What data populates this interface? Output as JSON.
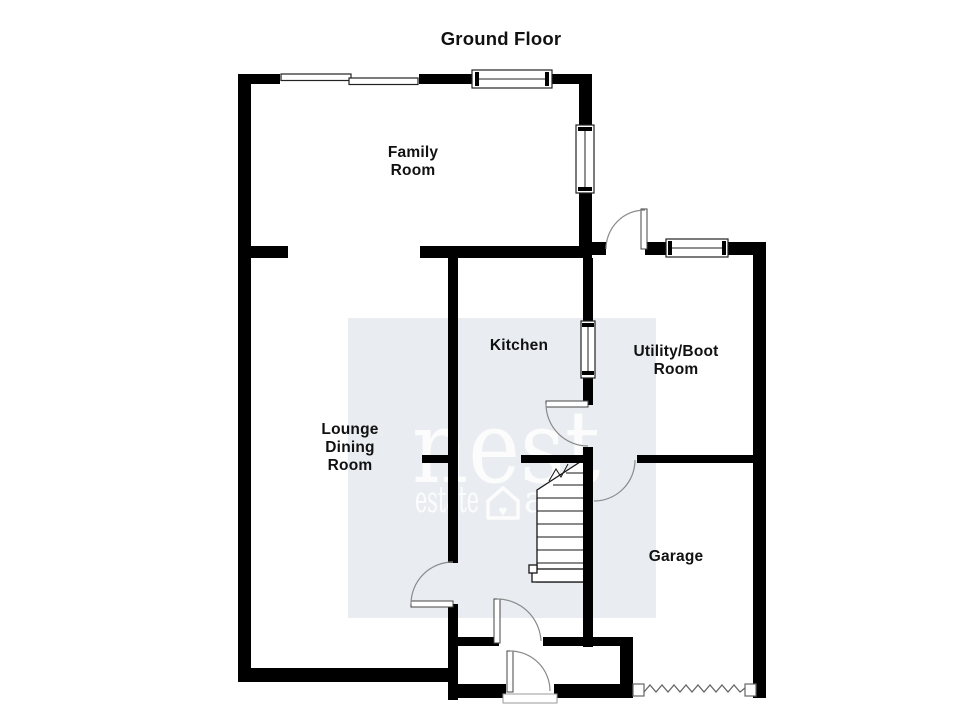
{
  "title": "Ground Floor",
  "rooms": {
    "family": {
      "label": "Family\nRoom"
    },
    "kitchen": {
      "label": "Kitchen"
    },
    "utility": {
      "label": "Utility/Boot\nRoom"
    },
    "lounge": {
      "label": "Lounge\nDining\nRoom"
    },
    "garage": {
      "label": "Garage"
    }
  },
  "watermark": {
    "brand": "nest",
    "sub_left": "estate",
    "sub_right": "a",
    "heart": "♥",
    "icon": "house-heart-icon",
    "panel_color": "#e9edf1",
    "text_color": "#ffffff"
  },
  "colors": {
    "wall": "#000000",
    "background": "#ffffff",
    "door_swing": "#8a8a8a"
  }
}
